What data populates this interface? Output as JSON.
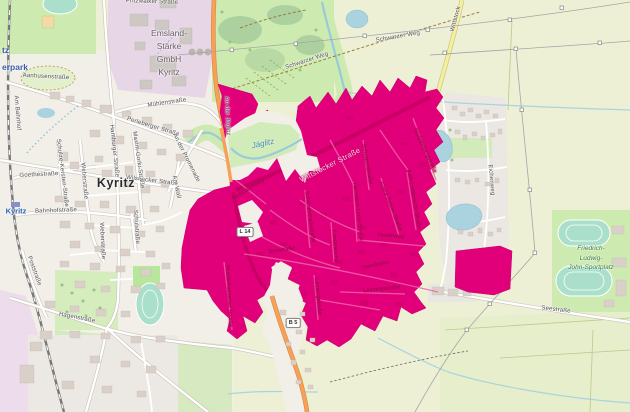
{
  "map": {
    "description": "OpenStreetMap style map of Kyritz with magenta highlighted zone",
    "colors": {
      "zone": "#e2007a",
      "zone_road": "#c80063",
      "zone_minor_road": "#ee66a8",
      "water": "#aad3df",
      "river_stroke": "#99c9da",
      "road_primary": "#f6a05a",
      "road_secondary": "#f2ef9e",
      "meadow": "#cdebb0",
      "forest": "#add19e",
      "farmland": "#eef0d5",
      "town_base": "#f2efe9",
      "industrial": "#e7d7e6",
      "building": "#d9d0c9",
      "pitch": "#aae0cb"
    },
    "badges": [
      {
        "text": "L 14",
        "x": 245,
        "y": 232
      },
      {
        "text": "B 5",
        "x": 293,
        "y": 323
      }
    ],
    "multiline_labels": [
      {
        "lines": [
          "Emsland-",
          "Stärke",
          "GmbH",
          "Kyritz"
        ],
        "x": 169,
        "y": 53,
        "cls": "poi-industrial"
      },
      {
        "lines": [
          "Friedrich-",
          "Ludwig-",
          "John-Sportplatz"
        ],
        "x": 591,
        "y": 258,
        "cls": "poi-green"
      }
    ],
    "labels": [
      {
        "text": "Kyritz",
        "x": 116,
        "y": 183,
        "rot": 0,
        "cls": "town"
      },
      {
        "text": "Kyritz",
        "x": 16,
        "y": 211,
        "rot": 0,
        "cls": "station"
      },
      {
        "text": "tz",
        "x": 2,
        "y": 50,
        "rot": 0,
        "cls": "poi-blue",
        "anch": "left"
      },
      {
        "text": "erpark",
        "x": 2,
        "y": 67,
        "rot": 0,
        "cls": "poi-blue",
        "anch": "left"
      },
      {
        "text": "Jäglitz",
        "x": 263,
        "y": 144,
        "rot": -12,
        "cls": "water"
      },
      {
        "text": "Perleberger Straße",
        "x": 153,
        "y": 127,
        "rot": 17,
        "cls": "street"
      },
      {
        "text": "Wilsnacker Straße",
        "x": 152,
        "y": 181,
        "rot": 7,
        "cls": "street"
      },
      {
        "text": "Aanhusenstraße",
        "x": 46,
        "y": 77,
        "rot": 3,
        "cls": "street"
      },
      {
        "text": "Goethestraße",
        "x": 39,
        "y": 175,
        "rot": -3,
        "cls": "street"
      },
      {
        "text": "Schulze-Kersten-Straße",
        "x": 62,
        "y": 173,
        "rot": 83,
        "cls": "street"
      },
      {
        "text": "Weberstraße",
        "x": 84,
        "y": 181,
        "rot": 85,
        "cls": "street"
      },
      {
        "text": "Hamburger Straße",
        "x": 114,
        "y": 151,
        "rot": 84,
        "cls": "street"
      },
      {
        "text": "Maxim-Gorki-Straße",
        "x": 138,
        "y": 160,
        "rot": 82,
        "cls": "street"
      },
      {
        "text": "Schulstraße",
        "x": 136,
        "y": 227,
        "rot": 86,
        "cls": "street"
      },
      {
        "text": "Weberstraße",
        "x": 102,
        "y": 241,
        "rot": 87,
        "cls": "street"
      },
      {
        "text": "Bahnhofstraße",
        "x": 56,
        "y": 211,
        "rot": -2,
        "cls": "street"
      },
      {
        "text": "Mühlenstraße",
        "x": 167,
        "y": 103,
        "rot": -8,
        "cls": "street"
      },
      {
        "text": "An der Promenade",
        "x": 186,
        "y": 158,
        "rot": 63,
        "cls": "street"
      },
      {
        "text": "Am Wall",
        "x": 176,
        "y": 187,
        "rot": 78,
        "cls": "street"
      },
      {
        "text": "Am Bahnhof",
        "x": 17,
        "y": 113,
        "rot": 85,
        "cls": "street"
      },
      {
        "text": "Poststraße",
        "x": 34,
        "y": 271,
        "rot": 70,
        "cls": "street"
      },
      {
        "text": "Hagenstraße",
        "x": 77,
        "y": 318,
        "rot": 11,
        "cls": "street"
      },
      {
        "text": "Pritzwalker Straße",
        "x": 152,
        "y": 2,
        "rot": 2,
        "cls": "street"
      },
      {
        "text": "An der Jäglitz",
        "x": 227,
        "y": 116,
        "rot": 87,
        "cls": "street"
      },
      {
        "text": "Wittstock",
        "x": 456,
        "y": 19,
        "rot": -75,
        "cls": "street"
      },
      {
        "text": "Schwarzer Weg",
        "x": 307,
        "y": 61,
        "rot": -18,
        "cls": "street"
      },
      {
        "text": "Schwarzer Weg",
        "x": 398,
        "y": 37,
        "rot": -10,
        "cls": "street"
      },
      {
        "text": "Seestraße",
        "x": 556,
        "y": 310,
        "rot": 7,
        "cls": "street"
      },
      {
        "text": "Eichenweg",
        "x": 491,
        "y": 180,
        "rot": 85,
        "cls": "street"
      },
      {
        "text": "Wittstocker Straße",
        "x": 330,
        "y": 165,
        "rot": -27,
        "cls": "road-main"
      },
      {
        "text": "Nußbaumweg",
        "x": 249,
        "y": 190,
        "rot": -32,
        "cls": "street-magenta"
      },
      {
        "text": "Schönermarkstraße",
        "x": 309,
        "y": 217,
        "rot": 82,
        "cls": "street-magenta"
      },
      {
        "text": "Fontaneweg",
        "x": 334,
        "y": 246,
        "rot": 85,
        "cls": "street-magenta"
      },
      {
        "text": "Hermann-Löns-Straße",
        "x": 357,
        "y": 212,
        "rot": 83,
        "cls": "street-magenta"
      },
      {
        "text": "Clara-Zetkin-Straße",
        "x": 390,
        "y": 207,
        "rot": 68,
        "cls": "street-magenta"
      },
      {
        "text": "Karl-Liebknecht-Straße",
        "x": 413,
        "y": 200,
        "rot": 80,
        "cls": "street-magenta"
      },
      {
        "text": "Stolpenbergstraße",
        "x": 424,
        "y": 151,
        "rot": 65,
        "cls": "street-magenta"
      },
      {
        "text": "Schützenstraße",
        "x": 366,
        "y": 164,
        "rot": 80,
        "cls": "street-magenta"
      },
      {
        "text": "Heideweg",
        "x": 391,
        "y": 237,
        "rot": 3,
        "cls": "street-magenta"
      },
      {
        "text": "Seestraße",
        "x": 282,
        "y": 251,
        "rot": -8,
        "cls": "street-magenta"
      },
      {
        "text": "Seestraße",
        "x": 376,
        "y": 266,
        "rot": -12,
        "cls": "street-magenta"
      },
      {
        "text": "Lessingstraße",
        "x": 317,
        "y": 297,
        "rot": 84,
        "cls": "street-magenta"
      },
      {
        "text": "Lessingstraße",
        "x": 382,
        "y": 290,
        "rot": -6,
        "cls": "street-magenta"
      },
      {
        "text": "Wusterhausener Straße",
        "x": 228,
        "y": 296,
        "rot": 87,
        "cls": "street-magenta"
      }
    ]
  }
}
